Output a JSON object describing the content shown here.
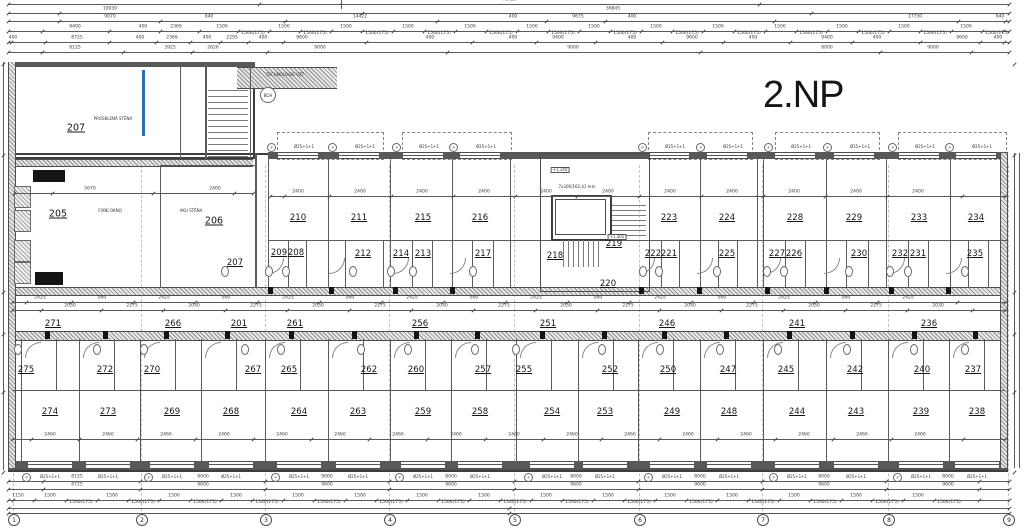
{
  "drawing": {
    "floor_label": "2.NP"
  },
  "colors": {
    "line": "#5a5a5a",
    "wall": "#585858",
    "glass_wall": "#2d6fb5",
    "background": "#ffffff"
  },
  "rooms": {
    "large": [
      {
        "n": "207",
        "x": 76,
        "y": 128
      },
      {
        "n": "205",
        "x": 58,
        "y": 214
      },
      {
        "n": "206",
        "x": 214,
        "y": 221
      }
    ],
    "top_row_y": 218,
    "top_row": [
      {
        "n": "210",
        "x": 298
      },
      {
        "n": "211",
        "x": 359
      },
      {
        "n": "215",
        "x": 423
      },
      {
        "n": "216",
        "x": 480
      },
      {
        "n": "223",
        "x": 669
      },
      {
        "n": "224",
        "x": 727
      },
      {
        "n": "228",
        "x": 795
      },
      {
        "n": "229",
        "x": 854
      },
      {
        "n": "233",
        "x": 919
      },
      {
        "n": "234",
        "x": 976
      }
    ],
    "entry_row_y": 254,
    "entry_row": [
      {
        "n": "207",
        "x": 235,
        "y": 263
      },
      {
        "n": "209",
        "x": 279,
        "y": 253
      },
      {
        "n": "208",
        "x": 296,
        "y": 253
      },
      {
        "n": "212",
        "x": 363
      },
      {
        "n": "214",
        "x": 401
      },
      {
        "n": "213",
        "x": 423
      },
      {
        "n": "217",
        "x": 483
      },
      {
        "n": "222",
        "x": 653
      },
      {
        "n": "221",
        "x": 669
      },
      {
        "n": "225",
        "x": 727
      },
      {
        "n": "227",
        "x": 777
      },
      {
        "n": "226",
        "x": 794
      },
      {
        "n": "230",
        "x": 859
      },
      {
        "n": "232",
        "x": 900
      },
      {
        "n": "231",
        "x": 918
      },
      {
        "n": "235",
        "x": 975
      }
    ],
    "core_rooms": [
      {
        "n": "218",
        "x": 555,
        "y": 256
      },
      {
        "n": "219",
        "x": 614,
        "y": 244
      },
      {
        "n": "220",
        "x": 608,
        "y": 284
      }
    ],
    "corridor_row_y": 324,
    "corridor_row": [
      {
        "n": "271",
        "x": 53
      },
      {
        "n": "266",
        "x": 173
      },
      {
        "n": "201",
        "x": 239
      },
      {
        "n": "261",
        "x": 295
      },
      {
        "n": "256",
        "x": 420
      },
      {
        "n": "251",
        "x": 548
      },
      {
        "n": "246",
        "x": 667
      },
      {
        "n": "241",
        "x": 797
      },
      {
        "n": "236",
        "x": 929
      }
    ],
    "lower_entry_row_y": 370,
    "lower_entry_row": [
      {
        "n": "275",
        "x": 26
      },
      {
        "n": "272",
        "x": 105
      },
      {
        "n": "270",
        "x": 152
      },
      {
        "n": "267",
        "x": 253
      },
      {
        "n": "265",
        "x": 289
      },
      {
        "n": "262",
        "x": 369
      },
      {
        "n": "260",
        "x": 416
      },
      {
        "n": "257",
        "x": 483
      },
      {
        "n": "255",
        "x": 524
      },
      {
        "n": "252",
        "x": 610
      },
      {
        "n": "250",
        "x": 668
      },
      {
        "n": "247",
        "x": 728
      },
      {
        "n": "245",
        "x": 786
      },
      {
        "n": "242",
        "x": 855
      },
      {
        "n": "240",
        "x": 922
      },
      {
        "n": "237",
        "x": 973
      }
    ],
    "bottom_row_y": 412,
    "bottom_row": [
      {
        "n": "274",
        "x": 50
      },
      {
        "n": "273",
        "x": 108
      },
      {
        "n": "269",
        "x": 172
      },
      {
        "n": "268",
        "x": 231
      },
      {
        "n": "264",
        "x": 299
      },
      {
        "n": "263",
        "x": 358
      },
      {
        "n": "259",
        "x": 423
      },
      {
        "n": "258",
        "x": 480
      },
      {
        "n": "254",
        "x": 552
      },
      {
        "n": "253",
        "x": 605
      },
      {
        "n": "249",
        "x": 672
      },
      {
        "n": "248",
        "x": 729
      },
      {
        "n": "244",
        "x": 797
      },
      {
        "n": "243",
        "x": 856
      },
      {
        "n": "239",
        "x": 921
      },
      {
        "n": "238",
        "x": 977
      }
    ]
  },
  "annotations": [
    {
      "t": "PROSKLENÁ STĚNA",
      "x": 113,
      "y": 119
    },
    {
      "t": "FIXNÍ OKNO",
      "x": 110,
      "y": 211
    },
    {
      "t": "AKU STĚNA",
      "x": 191,
      "y": 211
    },
    {
      "t": "TECHNOLOGIE VZT",
      "x": 285,
      "y": 75
    },
    {
      "t": "7x300/162,41 mm",
      "x": 577,
      "y": 187
    },
    {
      "t": "+1,305",
      "x": 617,
      "y": 237,
      "box": true
    },
    {
      "t": "+1,140",
      "x": 560,
      "y": 170,
      "box": true
    },
    {
      "t": "BCH",
      "x": 267,
      "y": 94,
      "circle": true
    }
  ],
  "balcony_note": {
    "p_mark": "P",
    "text": "Ø25+1+1"
  },
  "grid_bubbles": {
    "y": 519,
    "items": [
      {
        "n": "1",
        "x": 13
      },
      {
        "n": "2",
        "x": 141
      },
      {
        "n": "3",
        "x": 265
      },
      {
        "n": "4",
        "x": 389
      },
      {
        "n": "5",
        "x": 514
      },
      {
        "n": "6",
        "x": 639
      },
      {
        "n": "7",
        "x": 762
      },
      {
        "n": "8",
        "x": 888
      },
      {
        "n": "9",
        "x": 1008
      }
    ]
  },
  "dimensions": {
    "top_rows": [
      {
        "y": 4,
        "x1": 8,
        "x2": 1009,
        "labels": [
          {
            "x": 509,
            "t": "48725"
          }
        ]
      },
      {
        "y": 13,
        "x1": 8,
        "x2": 1009,
        "labels": [
          {
            "x": 110,
            "t": "10030"
          },
          {
            "x": 613,
            "t": "36845"
          }
        ]
      },
      {
        "y": 21,
        "x1": 8,
        "x2": 1009,
        "labels": [
          {
            "x": 110,
            "t": "9070"
          },
          {
            "x": 209,
            "t": "940"
          },
          {
            "x": 360,
            "t": "14422"
          },
          {
            "x": 513,
            "t": "400"
          },
          {
            "x": 578,
            "t": "9675"
          },
          {
            "x": 632,
            "t": "400"
          },
          {
            "x": 915,
            "t": "17730"
          },
          {
            "x": 1000,
            "t": "940"
          }
        ]
      },
      {
        "y": 31,
        "x1": 8,
        "x2": 1009,
        "labels": [
          {
            "x": 75,
            "t": "9400"
          },
          {
            "x": 143,
            "t": "400"
          },
          {
            "x": 176,
            "t": "2369"
          }
        ],
        "pattern": {
          "start": 222,
          "step": 31,
          "count": 26,
          "cycle": [
            "1500",
            "1500(175)"
          ]
        }
      },
      {
        "y": 42,
        "x1": 8,
        "x2": 1009,
        "labels": [
          {
            "x": 13,
            "t": "400"
          },
          {
            "x": 77,
            "t": "8725"
          },
          {
            "x": 140,
            "t": "400"
          },
          {
            "x": 172,
            "t": "2369"
          },
          {
            "x": 207,
            "t": "400"
          },
          {
            "x": 232,
            "t": "2295"
          },
          {
            "x": 263,
            "t": "400"
          },
          {
            "x": 302,
            "t": "9600"
          },
          {
            "x": 430,
            "t": "400"
          },
          {
            "x": 513,
            "t": "400"
          },
          {
            "x": 558,
            "t": "9400"
          },
          {
            "x": 632,
            "t": "400"
          },
          {
            "x": 692,
            "t": "9600"
          },
          {
            "x": 753,
            "t": "400"
          },
          {
            "x": 827,
            "t": "9400"
          },
          {
            "x": 877,
            "t": "400"
          },
          {
            "x": 962,
            "t": "9600"
          },
          {
            "x": 998,
            "t": "400"
          }
        ]
      },
      {
        "y": 52,
        "x1": 8,
        "x2": 1009,
        "labels": [
          {
            "x": 75,
            "t": "8125"
          },
          {
            "x": 170,
            "t": "3925"
          },
          {
            "x": 213,
            "t": "2626"
          },
          {
            "x": 320,
            "t": "9000"
          },
          {
            "x": 573,
            "t": "9000"
          },
          {
            "x": 827,
            "t": "8000"
          },
          {
            "x": 933,
            "t": "9000"
          }
        ]
      }
    ],
    "bottom_rows": [
      {
        "y": 481,
        "x1": 8,
        "x2": 1009,
        "labels": [
          {
            "x": 77,
            "t": "8125"
          },
          {
            "x": 203,
            "t": "9000"
          },
          {
            "x": 327,
            "t": "9000"
          },
          {
            "x": 451,
            "t": "8000"
          },
          {
            "x": 576,
            "t": "8000"
          },
          {
            "x": 700,
            "t": "8000"
          },
          {
            "x": 824,
            "t": "8000"
          },
          {
            "x": 948,
            "t": "8000"
          }
        ]
      },
      {
        "y": 489,
        "x1": 8,
        "x2": 1009,
        "labels": [
          {
            "x": 77,
            "t": "8725"
          },
          {
            "x": 203,
            "t": "9600"
          },
          {
            "x": 327,
            "t": "9600"
          },
          {
            "x": 451,
            "t": "9600"
          },
          {
            "x": 576,
            "t": "9600"
          },
          {
            "x": 700,
            "t": "9600"
          },
          {
            "x": 824,
            "t": "9600"
          },
          {
            "x": 948,
            "t": "9600"
          }
        ]
      },
      {
        "y": 500,
        "x1": 8,
        "x2": 1009,
        "labels": [
          {
            "x": 18,
            "t": "1150"
          }
        ],
        "pattern": {
          "start": 50,
          "step": 31,
          "count": 30,
          "cycle": [
            "1500",
            "1500(175)"
          ]
        }
      },
      {
        "y": 508,
        "x1": 8,
        "x2": 1009,
        "labels": []
      },
      {
        "y": 513,
        "x1": 8,
        "x2": 1009,
        "labels": []
      }
    ],
    "corridor_rows": [
      {
        "y": 302,
        "x1": 12,
        "x2": 1005,
        "pattern": {
          "start": 40,
          "step": 62,
          "count": 15,
          "cycle": [
            "2425",
            "900"
          ]
        }
      },
      {
        "y": 310,
        "x1": 12,
        "x2": 1005,
        "pattern": {
          "start": 70,
          "step": 62,
          "count": 15,
          "cycle": [
            "2030",
            "2275"
          ]
        }
      }
    ],
    "room_rows": [
      {
        "y": 196,
        "x1": 270,
        "x2": 1005,
        "pattern": {
          "start": 298,
          "step": 62,
          "count": 11,
          "cycle": [
            "2400"
          ]
        }
      },
      {
        "y": 193,
        "x1": 14,
        "x2": 253,
        "labels": [
          {
            "x": 90,
            "t": "5670"
          },
          {
            "x": 215,
            "t": "2400"
          }
        ]
      },
      {
        "y": 439,
        "x1": 12,
        "x2": 1005,
        "pattern": {
          "start": 50,
          "step": 58,
          "count": 16,
          "cycle": [
            "2460"
          ]
        }
      }
    ]
  }
}
